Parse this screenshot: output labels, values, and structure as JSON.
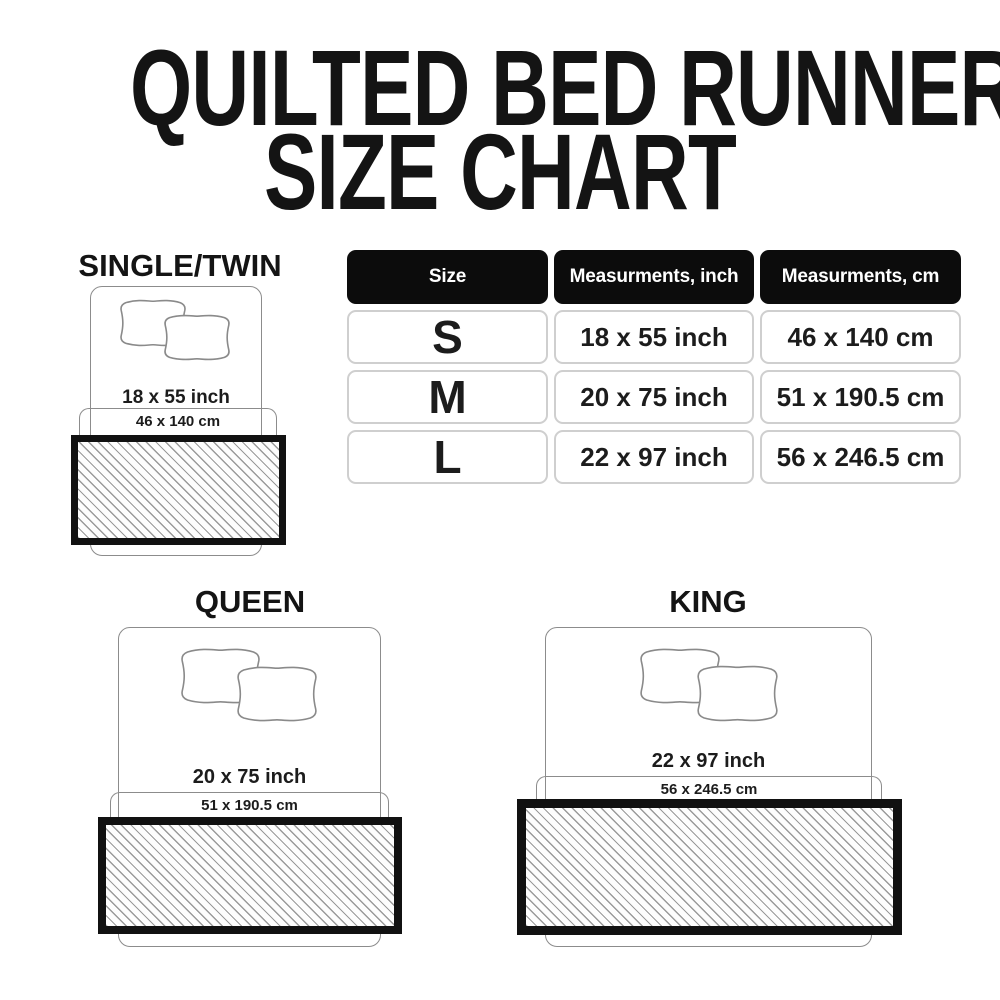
{
  "title": {
    "line1": "QUILTED BED RUNNER",
    "line2": "SIZE CHART"
  },
  "table": {
    "headers": [
      "Size",
      "Measurments, inch",
      "Measurments, cm"
    ],
    "rows": [
      {
        "size": "S",
        "inch": "18 x 55 inch",
        "cm": "46 x 140 cm"
      },
      {
        "size": "M",
        "inch": "20 x 75 inch",
        "cm": "51 x 190.5 cm"
      },
      {
        "size": "L",
        "inch": "22 x 97 inch",
        "cm": "56 x 246.5 cm"
      }
    ]
  },
  "diagrams": [
    {
      "id": "single-twin",
      "label": "SINGLE/TWIN",
      "inch": "18 x 55 inch",
      "cm": "46 x 140 cm"
    },
    {
      "id": "queen",
      "label": "QUEEN",
      "inch": "20 x 75 inch",
      "cm": "51 x 190.5 cm"
    },
    {
      "id": "king",
      "label": "KING",
      "inch": "22 x 97 inch",
      "cm": "56 x 246.5 cm"
    }
  ],
  "icons": {
    "pillow": "pillow-icon",
    "runner_swatch": "hatched-runner-swatch"
  },
  "colors": {
    "background": "#ffffff",
    "text": "#161616",
    "header_bg": "#0c0c0c",
    "header_text": "#ffffff",
    "cell_border": "#cfcfcf",
    "bed_outline": "#8c8c8c",
    "hatch_line": "#9a9a9a",
    "runner_border": "#111111"
  }
}
